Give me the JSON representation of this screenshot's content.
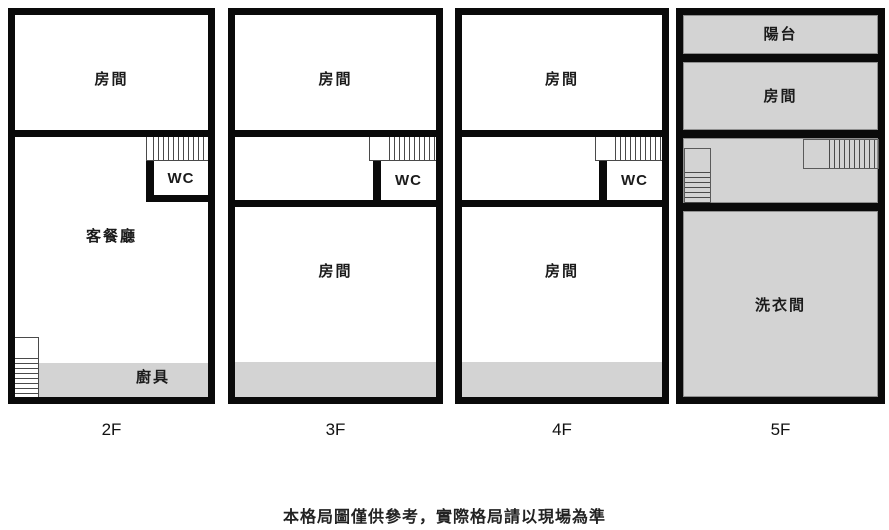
{
  "caption": "本格局圖僅供參考，實際格局請以現場為準",
  "colors": {
    "wall": "#0a0a0a",
    "room_fill": "#ffffff",
    "gray_fill": "#d3d3d3",
    "stair_line": "#4a4a4a",
    "text": "#1b1b1b"
  },
  "floors": [
    {
      "label": "2F",
      "rooms": {
        "bedroom": "房間",
        "living_dining": "客餐廳",
        "wc": "WC",
        "kitchen": "廚具"
      }
    },
    {
      "label": "3F",
      "rooms": {
        "bedroom_top": "房間",
        "wc": "WC",
        "bedroom_bottom": "房間"
      }
    },
    {
      "label": "4F",
      "rooms": {
        "bedroom_top": "房間",
        "wc": "WC",
        "bedroom_bottom": "房間"
      }
    },
    {
      "label": "5F",
      "rooms": {
        "balcony": "陽台",
        "bedroom": "房間",
        "laundry": "洗衣間"
      }
    }
  ]
}
